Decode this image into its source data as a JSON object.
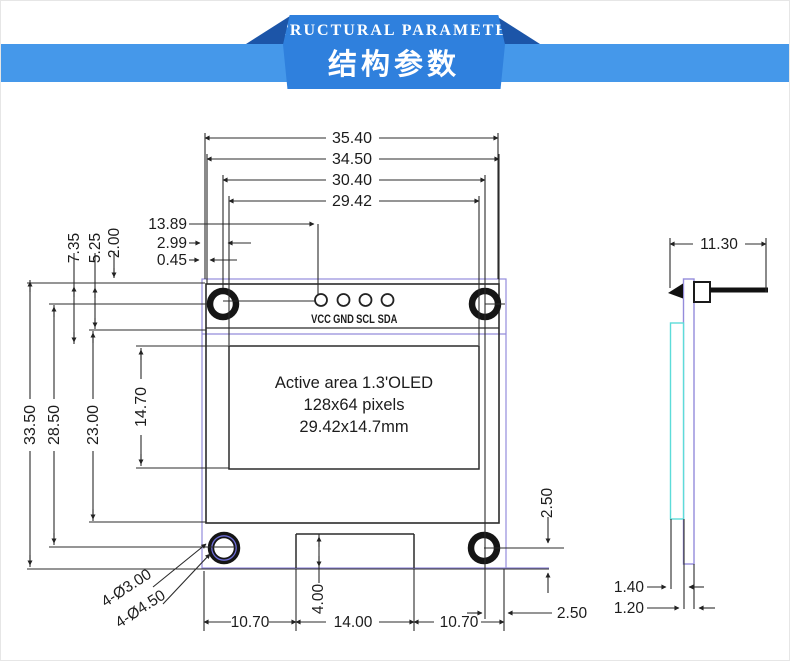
{
  "banner": {
    "title_en": "STRUCTURAL PARAMETER",
    "title_zh": "结构参数",
    "band_color": "#4598ea",
    "ribbon_color": "#2f80dd",
    "fold_color": "#1c55a8"
  },
  "front_view": {
    "pin_labels": [
      "VCC",
      "GND",
      "SCL",
      "SDA"
    ],
    "active_area": {
      "line1": "Active area 1.3'OLED",
      "line2": "128x64 pixels",
      "line3": "29.42x14.7mm"
    },
    "dims": {
      "width_board": "35.40",
      "width_glass": "34.50",
      "width_hole_span": "30.40",
      "width_active": "29.42",
      "pin1_offset": "13.89",
      "hole_offset": "2.99",
      "glass_offset": "0.45",
      "top_to_active": "7.35",
      "top_to_pin_row": "5.25",
      "top_to_pin": "2.00",
      "height_board": "33.50",
      "hole_span_v": "28.50",
      "glass_height": "23.00",
      "active_height": "14.70",
      "holes_inner": "4-Ø3.00",
      "holes_outer": "4-Ø4.50",
      "bottom_left": "10.70",
      "bottom_tab": "14.00",
      "bottom_right": "10.70",
      "tab_height": "4.00",
      "hole_to_bottom": "2.50",
      "hole_to_edge": "2.50"
    }
  },
  "side_view": {
    "dims": {
      "total_width": "11.30",
      "glass_thickness": "1.40",
      "pcb_thickness": "1.20"
    }
  },
  "colors": {
    "line": "#2b2b2b",
    "pcb_outline": "#948cdb",
    "glass_outline": "#5ddcd9",
    "hole_ring_accent": "#6b6bd4"
  }
}
